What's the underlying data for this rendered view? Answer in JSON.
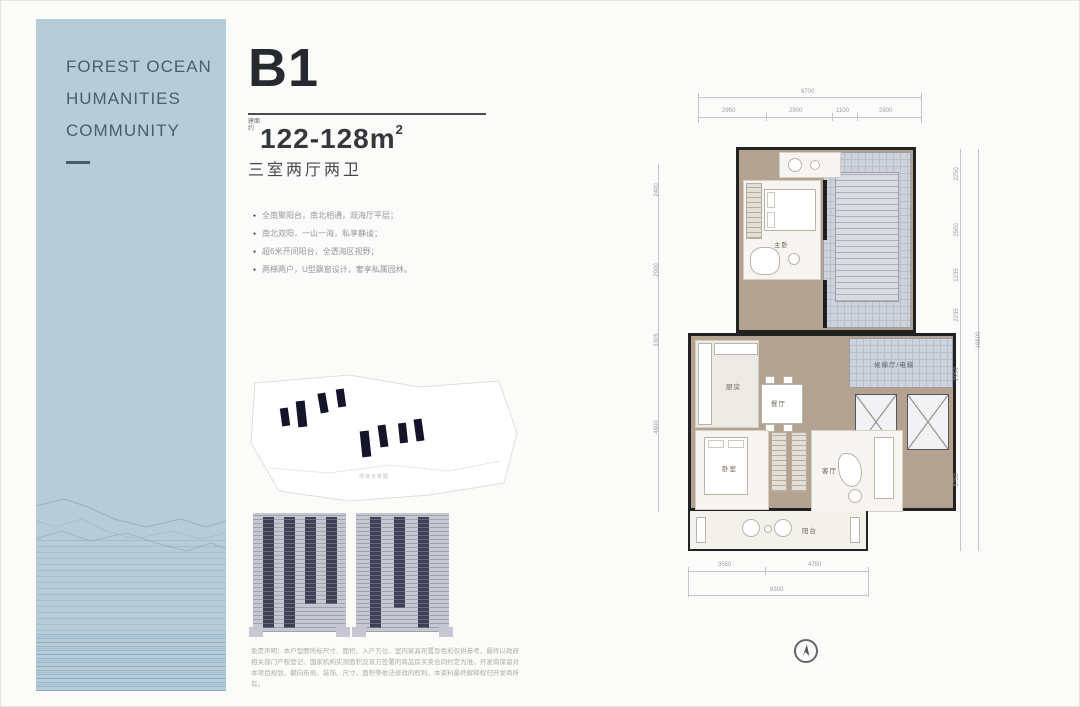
{
  "sidebar": {
    "line1": "FOREST OCEAN",
    "line2": "HUMANITIES",
    "line3": "COMMUNITY",
    "bg_color": "#b6cdd9",
    "text_color": "#4b5c6b"
  },
  "info": {
    "unit_name": "B1",
    "area_prefix": "建面约",
    "area_value": "122-128m",
    "area_sup": "2",
    "layout": "三室两厅两卫",
    "bullets": [
      "全南聚阳台，南北相通，观海厅平层；",
      "南北双阳，一山一海，私享静谧；",
      "超6米开间阳台，全透海区视野；",
      "两梯两户，U型飘窗设计，奢享私属园林。"
    ],
    "siteplan_caption": "项目示意图",
    "disclaimer": "免责声明：本户型图所标尺寸、面积、入户方位、室内家具布置及色彩仅供参考，最终以政府相关部门产权登记、国家机构实测面积及双方签署的商品房买卖合同约定为准。开发商保留对本项目规划、朝向布局、装饰、尺寸、面积等依法修改的权利，本资料最终解释权归开发商所有。"
  },
  "floorplan": {
    "rooms": {
      "bedroom_top": "主卧",
      "kitchen": "厨房",
      "dining": "餐厅",
      "bedroom": "卧室",
      "living": "客厅",
      "balcony": "阳台",
      "lobby": "候梯厅/电梯"
    },
    "dims_top": {
      "overall": "9700",
      "segments": [
        "2950",
        "2900",
        "1100",
        "2800"
      ]
    },
    "dims_bottom": {
      "overall": "8300",
      "segments": [
        "3550",
        "4750"
      ]
    },
    "dims_right": {
      "overall": "16600",
      "segments": [
        "2250",
        "2500",
        "1235",
        "2235",
        "2950",
        "3750"
      ]
    },
    "dims_left": {
      "segments": [
        "2400",
        "2900",
        "3305",
        "4600"
      ]
    }
  }
}
